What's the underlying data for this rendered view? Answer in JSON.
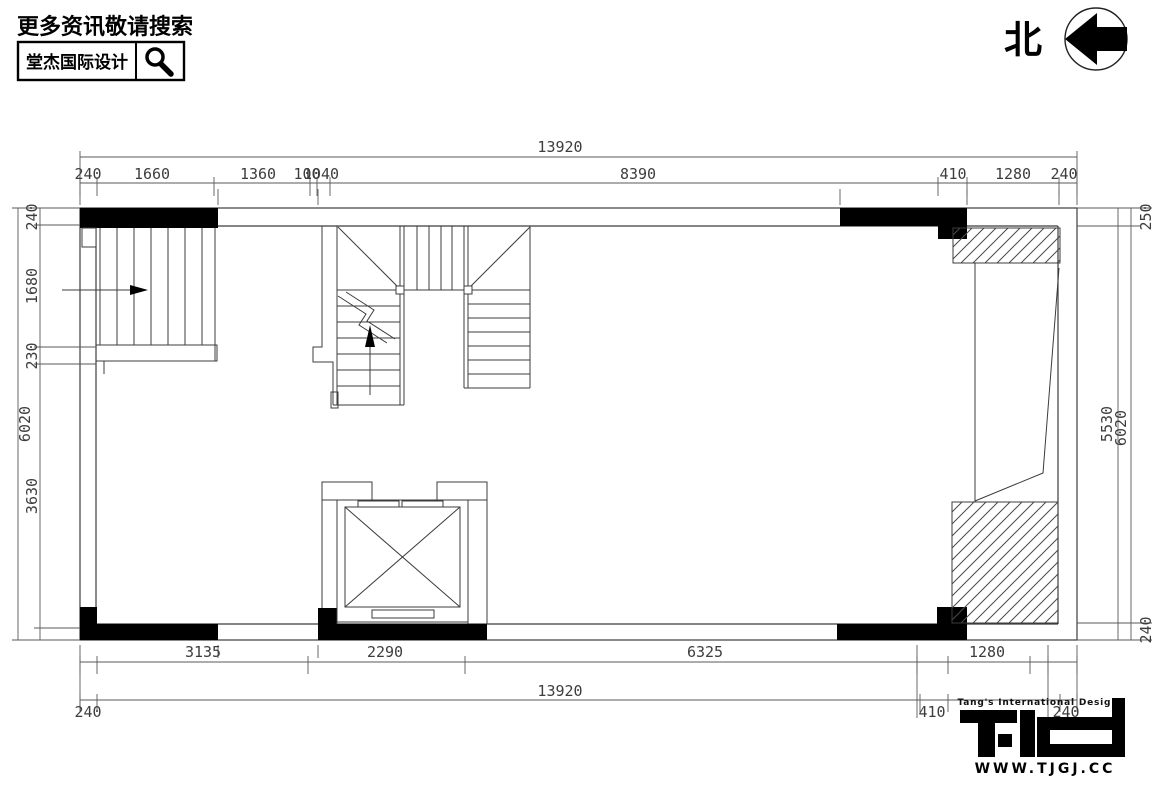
{
  "header": {
    "tagline": "更多资讯敬请搜索",
    "brand": "堂杰国际设计"
  },
  "compass": {
    "north_label": "北"
  },
  "plan": {
    "ink_color": "#000000",
    "paper_color": "#ffffff"
  },
  "dims": {
    "top_total": "13920",
    "top": {
      "s1": "240",
      "s2": "1660",
      "s3": "1360",
      "s4": "100",
      "s5": "1040",
      "s6": "8390",
      "s7": "410",
      "s8": "1280",
      "s9": "240"
    },
    "left": {
      "total": "6020",
      "s1": "240",
      "s2": "1680",
      "s3": "230",
      "s4": "3630"
    },
    "right": {
      "s1": "250",
      "s2": "5530",
      "total": "6020",
      "s3": "240"
    },
    "bottom": {
      "s1": "3135",
      "s2": "2290",
      "s3": "6325",
      "s4": "1280",
      "total": "13920",
      "e1": "240",
      "e2": "410",
      "e3": "240"
    }
  },
  "footer": {
    "tagline": "Tang's International Design",
    "website": "WWW.TJGJ.CC"
  }
}
